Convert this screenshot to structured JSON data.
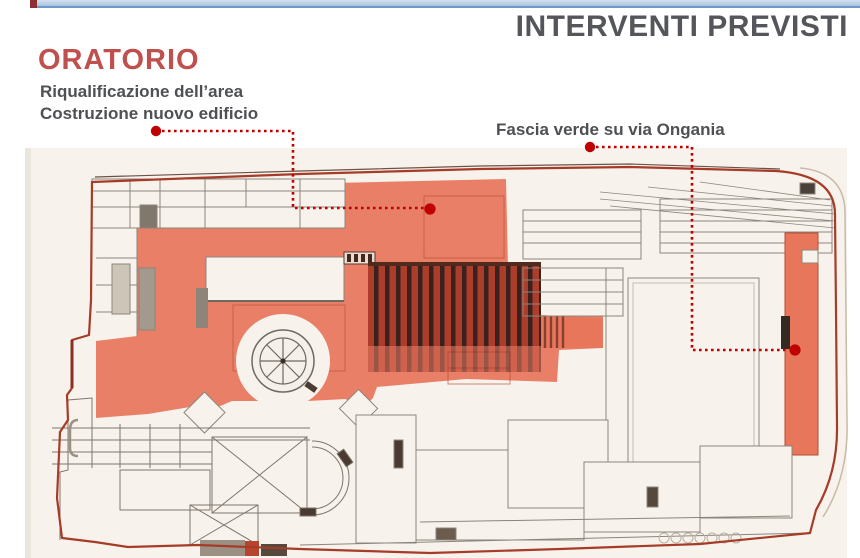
{
  "slide": {
    "title": "INTERVENTI PREVISTI",
    "section_heading": "ORATORIO",
    "subtitle_lines": [
      "Riqualificazione dell’area",
      "Costruzione nuovo edificio"
    ],
    "annotation": "Fascia verde su via Ongania"
  },
  "colors": {
    "accent_red": "#C0504D",
    "title_gray": "#54565B",
    "leader_red": "#C00000",
    "topbar_blue": "#A9C3DE",
    "plan_highlight_salmon": "#E86A50",
    "plan_paper": "#F7F3EC"
  },
  "plan": {
    "name": "site-plan-oratorio",
    "highlighted_areas": [
      "Area oratorio",
      "Fascia verde su via Ongania"
    ]
  }
}
